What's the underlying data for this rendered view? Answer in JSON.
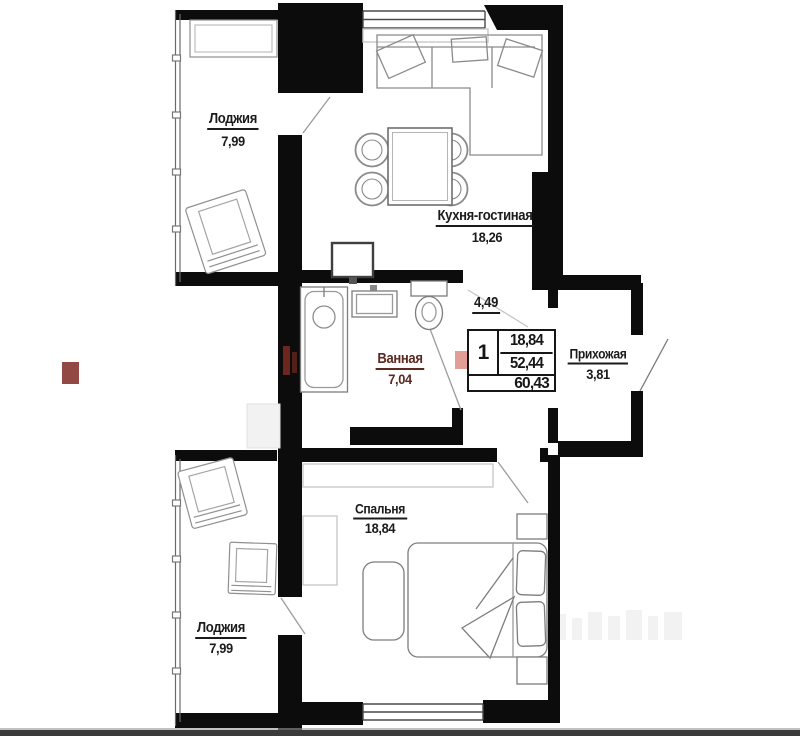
{
  "plan": {
    "title": "apartment floor plan",
    "rooms": [
      {
        "id": "loggia-top",
        "name": "Лоджия",
        "area": "7,99"
      },
      {
        "id": "kitchen-living",
        "name": "Кухня-гостиная",
        "area": "18,26"
      },
      {
        "id": "bathroom",
        "name": "Ванная",
        "area": "7,04"
      },
      {
        "id": "corridor",
        "name": "",
        "area": "4,49"
      },
      {
        "id": "hallway",
        "name": "Прихожая",
        "area": "3,81"
      },
      {
        "id": "bedroom",
        "name": "Спальня",
        "area": "18,84"
      },
      {
        "id": "loggia-bottom",
        "name": "Лоджия",
        "area": "7,99"
      }
    ],
    "stamp": {
      "rooms_count": "1",
      "living_area": "18,84",
      "apartment_area": "52,44",
      "total_area": "60,43"
    },
    "colors": {
      "wall": "#0c0c0c",
      "furniture_line": "#8a8a8a",
      "label": "#1b1b1b",
      "bathroom_label": "#5b2a21",
      "watermark_red": "#b5342a",
      "bottom_strip": "#3a3a3a"
    }
  }
}
